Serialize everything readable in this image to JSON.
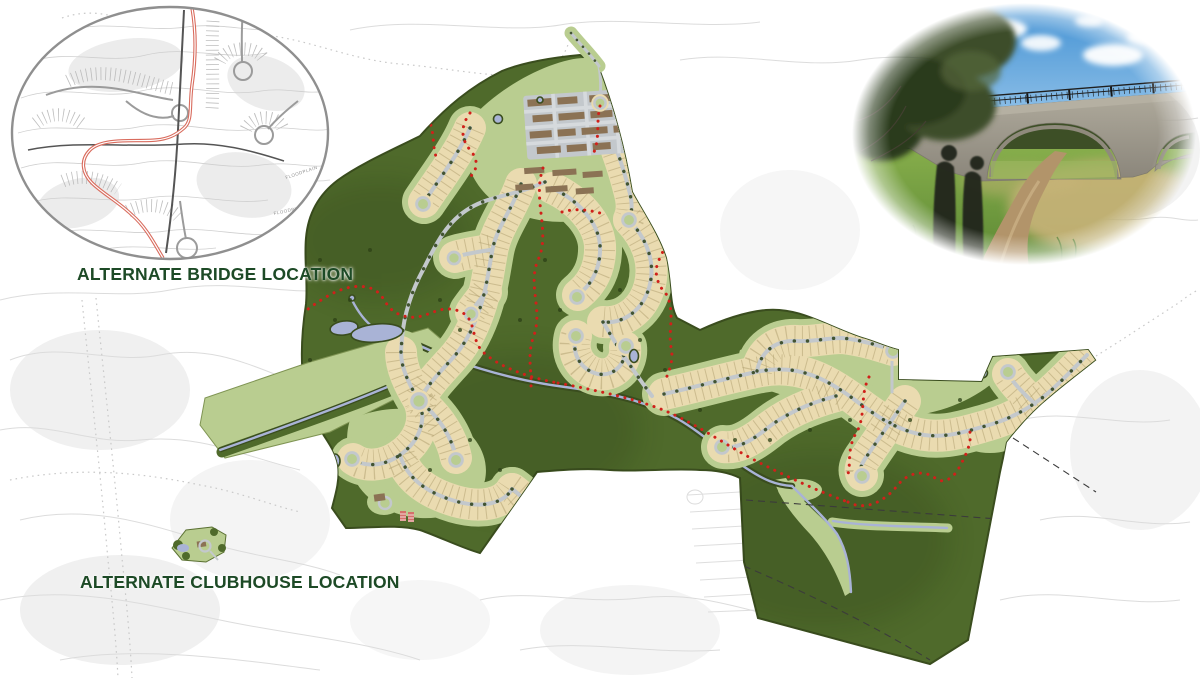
{
  "sheet": {
    "width": 1200,
    "height": 679
  },
  "annotations": {
    "bridge_inset": {
      "label": "ALTERNATE BRIDGE LOCATION",
      "floodplain_1": "FLOODPLAIN",
      "floodplain_2": "FLOODPLAIN"
    },
    "clubhouse": {
      "label": "ALTERNATE CLUBHOUSE LOCATION"
    }
  },
  "colors": {
    "olive": "#4f6a2b",
    "olive-dark": "#3a4d1e",
    "lgreen": "#b9cd90",
    "tan": "#eadbb0",
    "lotline": "#b3a273",
    "road": "#c3c8cc",
    "tree": "#2c4016",
    "water": "#a9b3d6",
    "trail": "#d0201a",
    "bldg": "#8b7254",
    "garden": "#d4716a",
    "label": "#1d4a26",
    "sketch": "#dcdcdc",
    "sketch2": "#c9c9c9",
    "blob": "#f0f0f0",
    "insetline": "#9b9b9b",
    "insetdark": "#555555",
    "insetred": "#d96c5e",
    "boundary": "#3b3b3b"
  },
  "map": {
    "type": "land-development-master-plan",
    "features": [
      "open-space-dark-green",
      "amenity-lawn-light-green",
      "single-family-lot-bands-tan",
      "multifamily-buildings-brown",
      "streets-gray-with-street-trees",
      "cul-de-sacs",
      "pedestrian-trail-red-dotted",
      "ponds-and-streams-blue",
      "preserve-boundary-dashed",
      "alternate-bridge-road-alignment-red",
      "offsite-context-sketch-gray",
      "bridge-trail-photo"
    ]
  }
}
